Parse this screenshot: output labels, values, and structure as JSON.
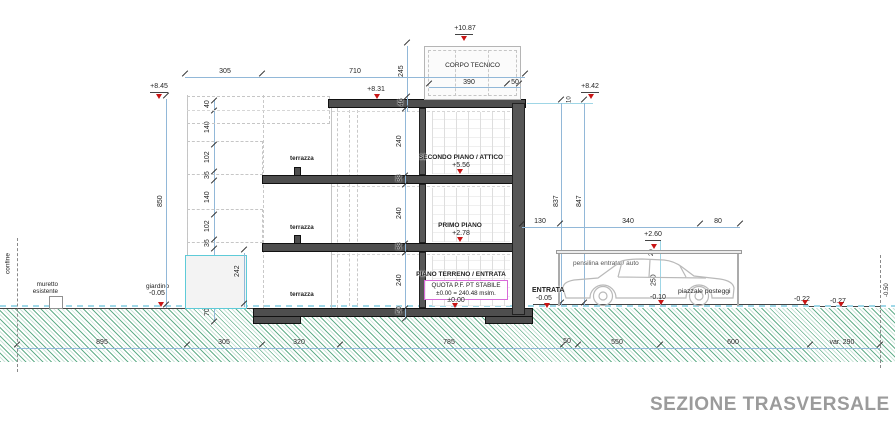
{
  "title": "SEZIONE TRASVERSALE",
  "colors": {
    "marker_red": "#c81515",
    "dim_blue": "#92b8d8",
    "hatch_green": "#38986a",
    "cyan_accent": "#5ecbd8",
    "magenta_box": "#d86ad8",
    "title_gray": "#9b9b9b"
  },
  "floors": {
    "secondo": {
      "name": "SECONDO PIANO / ATTICO",
      "quota": "+5.56"
    },
    "primo": {
      "name": "PRIMO PIANO",
      "quota": "+2.78"
    },
    "terreno": {
      "name": "PIANO TERRENO / ENTRATA",
      "quota": "±0.00"
    },
    "terrazza": "terrazza",
    "quota_box": {
      "line1": "QUOTA P.F. PT STABILE",
      "line2": "±0.00 = 240.48 mslm."
    }
  },
  "roof": {
    "corpo_tecnico": "CORPO TECNICO",
    "quota_corpo": "+10.87",
    "quota_parapet_left": "+8.45",
    "quota_roof": "+8.31",
    "quota_right": "+8.42"
  },
  "site": {
    "entrata": {
      "label": "ENTRATA",
      "quota": "-0.05"
    },
    "pensilina": {
      "label": "pensilina entrata / auto",
      "quota": "+2.60"
    },
    "piazzale": {
      "label": "piazzale posteggi",
      "quota1": "-0.10",
      "quota2": "-0.22",
      "quota3": "-0.27"
    },
    "giardino": {
      "label": "giardino",
      "quota": "-0.05"
    },
    "muretto": {
      "line1": "muretto",
      "line2": "esistente"
    },
    "confine_left": "confine",
    "right_edge_quota": "-0.50"
  },
  "dims": {
    "top": {
      "terrace": "305",
      "body": "710"
    },
    "corpo": {
      "width": "390",
      "side": "50",
      "height": "245",
      "parapet": "46"
    },
    "left": {
      "overall": "850",
      "chain": [
        "40",
        "140",
        "102",
        "36",
        "140",
        "102",
        "36"
      ],
      "garden_box": "242",
      "below_ground": "70"
    },
    "interior": {
      "chain": [
        "240",
        "38",
        "240",
        "38",
        "240",
        "50"
      ]
    },
    "right": {
      "a": "837",
      "b": "847",
      "gap": "10"
    },
    "pensilina": {
      "segments": [
        "130",
        "340",
        "80"
      ],
      "beam": "20",
      "clearance": "250"
    },
    "bottom": [
      "895",
      "305",
      "320",
      "785",
      "50",
      "550",
      "600",
      "var. 290"
    ]
  }
}
